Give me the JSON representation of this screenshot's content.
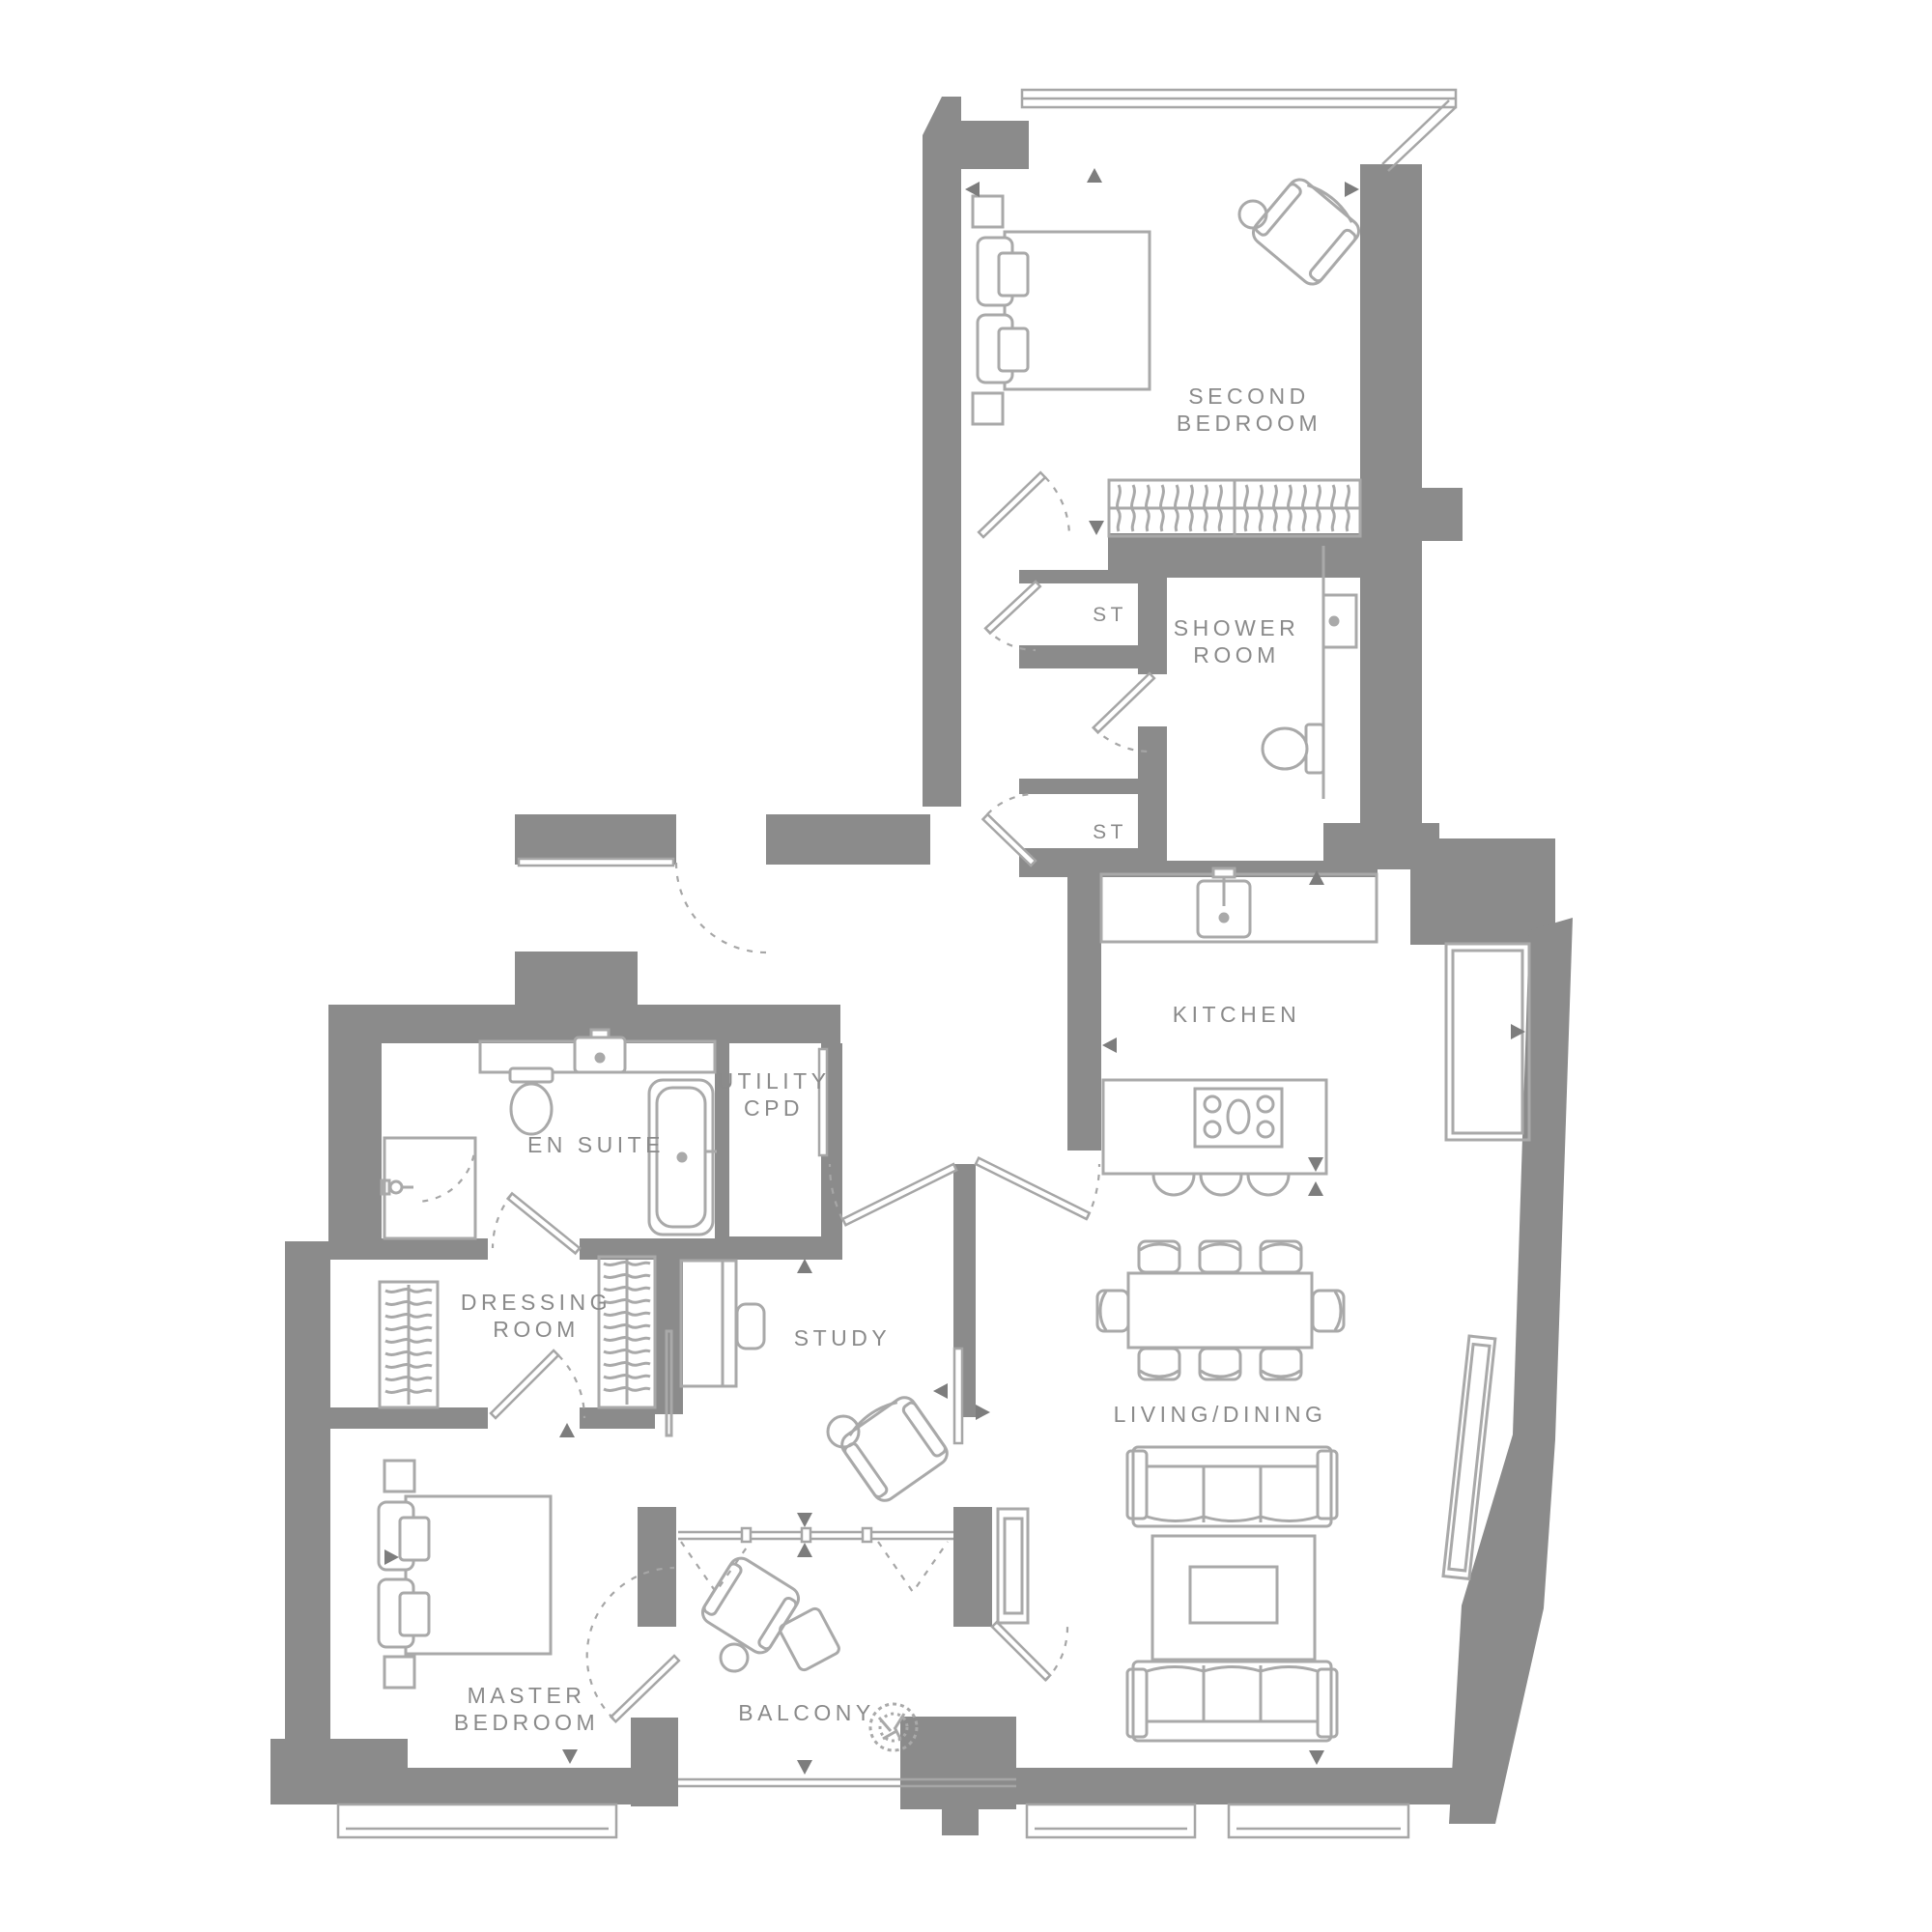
{
  "colors": {
    "background": "#ffffff",
    "wall": "#8b8b8b",
    "line": "#a6a6a6",
    "furniture": "#a9a9a9",
    "text": "#8a8a8a",
    "arrow": "#7d7d7d"
  },
  "rooms": {
    "second_bedroom": {
      "name": [
        "SECOND",
        "BEDROOM"
      ]
    },
    "storage_top": {
      "name": [
        "ST"
      ]
    },
    "shower_room": {
      "name": [
        "SHOWER",
        "ROOM"
      ]
    },
    "storage_mid": {
      "name": [
        "ST"
      ]
    },
    "kitchen": {
      "name": [
        "KITCHEN"
      ]
    },
    "utility": {
      "name": [
        "UTILITY",
        "CPD"
      ]
    },
    "en_suite": {
      "name": [
        "EN SUITE"
      ]
    },
    "dressing_room": {
      "name": [
        "DRESSING",
        "ROOM"
      ]
    },
    "study": {
      "name": [
        "STUDY"
      ]
    },
    "living_dining": {
      "name": [
        "LIVING/DINING"
      ]
    },
    "master_bedroom": {
      "name": [
        "MASTER",
        "BEDROOM"
      ]
    },
    "balcony": {
      "name": [
        "BALCONY"
      ]
    }
  }
}
